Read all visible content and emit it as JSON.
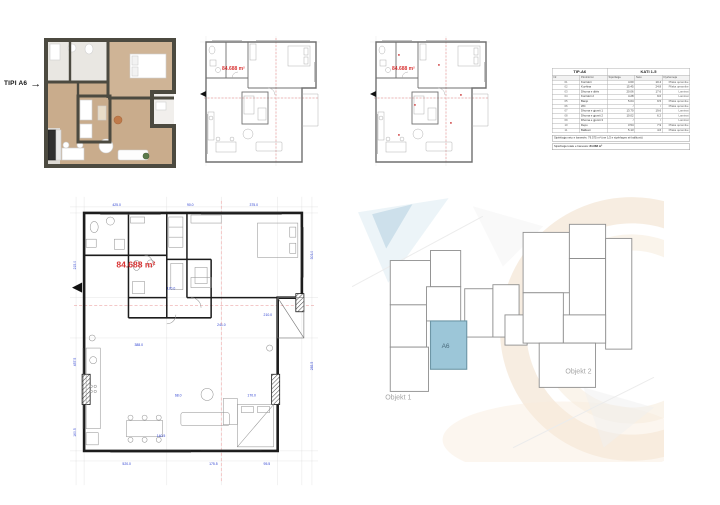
{
  "labels": {
    "tip": "TIPI A6",
    "arrow": "→",
    "area_m2": "84.688 m²",
    "unit": "A6",
    "objekt1": "Objekt 1",
    "objekt2": "Objekt 2"
  },
  "big_plan": {
    "area": "84.688 m²",
    "dims": [
      "425.0",
      "90.0",
      "375.0",
      "215.0",
      "457.5",
      "160.5",
      "303.0",
      "283.5",
      "520.0",
      "175.5",
      "95.5",
      "120.0",
      "241.0",
      "388.0",
      "170.0",
      "68.0",
      "140.5",
      "210.0"
    ]
  },
  "table": {
    "title_left": "TIP-A6",
    "title_right": "KATI 1-5",
    "columns": [
      "Nr.",
      "Përshkrimi",
      "Sipërfaqja",
      "Neto",
      "Dyshemeja"
    ],
    "rows": [
      [
        "01",
        "Korridori",
        "4.60",
        "10.4",
        "Pllaka qeramike"
      ],
      [
        "02",
        "Kuzhina",
        "15.45",
        "24.8",
        "Pllaka qeramike"
      ],
      [
        "03",
        "Dhoma e ditës",
        "20.06",
        "17.6",
        "Laminat"
      ],
      [
        "04",
        "Korridori 2",
        "4.28",
        "9.0",
        "Laminat"
      ],
      [
        "05",
        "Banjo",
        "5.04",
        "9.5",
        "Pllaka qeramike"
      ],
      [
        "06",
        "WC",
        "/",
        "/",
        "Pllaka qeramike"
      ],
      [
        "07",
        "Dhoma e gjumit 1",
        "13.70",
        "19.6",
        "Laminat"
      ],
      [
        "08",
        "Dhoma e gjumit 2",
        "10.02",
        "6.2",
        "Laminat"
      ],
      [
        "09",
        "Dhoma e gjumit 3",
        "/",
        "/",
        "Laminat"
      ],
      [
        "10",
        "Depo",
        "3.54",
        "7.9",
        "Pllaka qeramike"
      ],
      [
        "11",
        "Ballkoni",
        "5.13",
        "4.6",
        "Pllaka qeramike"
      ]
    ],
    "note1": "Sipërfaqja neto e banesës: 79.575 m² (me 1/2 e sipërfaqes së ballkonit)",
    "note2_label": "Sipërfaqja totale e banesës: ",
    "note2_value": "84.688 m²"
  },
  "colors": {
    "accent_red": "#d93636",
    "dim_blue": "#2b3fd0",
    "unit_fill": "#9cc6d8",
    "unit_stroke": "#6d96a6",
    "wall_dark": "#1c1c1c",
    "watermark_tan": "#f1dfc8",
    "watermark_blue": "#aeccdd"
  }
}
